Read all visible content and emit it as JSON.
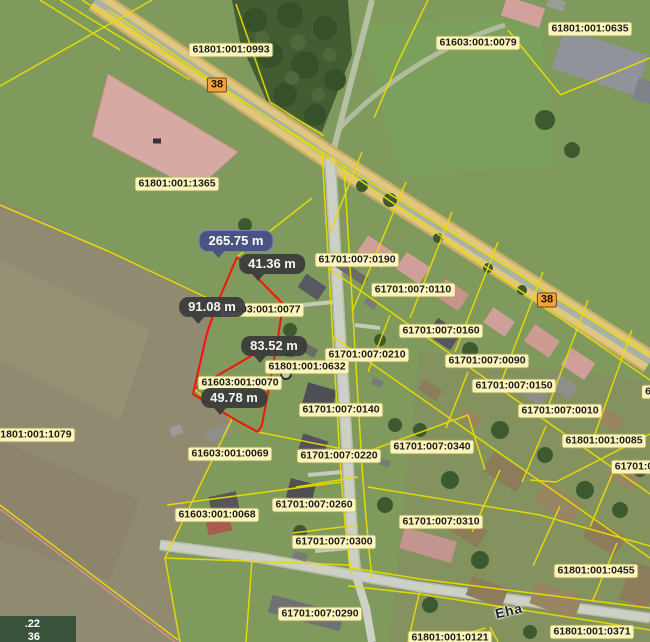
{
  "theme": {
    "parcel_line": "#e8dc00",
    "measure_line": "#f21404",
    "label_bg": "#fcf5bb",
    "label_text": "#1c1c1c",
    "measure_primary_bg": "#4a5383",
    "measure_secondary_bg": "#3b3b3b",
    "road_badge_bg": "#f2a33c",
    "highlight_field_fill": "#d6a9a3"
  },
  "map": {
    "parcel_labels": [
      {
        "text": "61801:001:0993",
        "x": 231,
        "y": 50
      },
      {
        "text": "61603:001:0079",
        "x": 478,
        "y": 43
      },
      {
        "text": "61801:001:0635",
        "x": 590,
        "y": 29
      },
      {
        "text": "61801:001:1365",
        "x": 177,
        "y": 184
      },
      {
        "text": "61701:007:0190",
        "x": 357,
        "y": 260
      },
      {
        "text": "61701:007:0110",
        "x": 413,
        "y": 290
      },
      {
        "text": "61603:001:0077",
        "x": 262,
        "y": 310
      },
      {
        "text": "61701:007:0160",
        "x": 441,
        "y": 331
      },
      {
        "text": "61701:007:0210",
        "x": 367,
        "y": 355
      },
      {
        "text": "61701:007:0090",
        "x": 487,
        "y": 361
      },
      {
        "text": "61801:001:0632",
        "x": 307,
        "y": 367
      },
      {
        "text": "61701:007:0150",
        "x": 514,
        "y": 386
      },
      {
        "text": "61603:001:0070",
        "x": 240,
        "y": 383
      },
      {
        "text": "61701:007:0140",
        "x": 341,
        "y": 410
      },
      {
        "text": "61701:007:0010",
        "x": 560,
        "y": 411
      },
      {
        "text": "61801:001:1079",
        "x": 33,
        "y": 435
      },
      {
        "text": "61801:001:0085",
        "x": 604,
        "y": 441
      },
      {
        "text": "61701:007:0340",
        "x": 432,
        "y": 447
      },
      {
        "text": "61603:001:0069",
        "x": 230,
        "y": 454
      },
      {
        "text": "61701:007:0220",
        "x": 339,
        "y": 456
      },
      {
        "text": "61701:0",
        "x": 634,
        "y": 467
      },
      {
        "text": "6",
        "x": 648,
        "y": 392
      },
      {
        "text": "61701:007:0260",
        "x": 314,
        "y": 505
      },
      {
        "text": "61603:001:0068",
        "x": 217,
        "y": 515
      },
      {
        "text": "61701:007:0310",
        "x": 441,
        "y": 522
      },
      {
        "text": "61701:007:0300",
        "x": 334,
        "y": 542
      },
      {
        "text": "61801:001:0455",
        "x": 596,
        "y": 571
      },
      {
        "text": "61701:007:0290",
        "x": 320,
        "y": 614
      },
      {
        "text": "61801:001:0371",
        "x": 592,
        "y": 632
      },
      {
        "text": "61801:001:0121",
        "x": 450,
        "y": 638
      }
    ],
    "road_badges": [
      {
        "text": "38",
        "x": 217,
        "y": 85
      },
      {
        "text": "38",
        "x": 547,
        "y": 300
      }
    ],
    "measurements": [
      {
        "text": "265.75 m",
        "x": 236,
        "y": 241,
        "variant": "primary"
      },
      {
        "text": "41.36 m",
        "x": 272,
        "y": 264,
        "variant": "secondary"
      },
      {
        "text": "91.08 m",
        "x": 212,
        "y": 307,
        "variant": "secondary"
      },
      {
        "text": "83.52 m",
        "x": 274,
        "y": 346,
        "variant": "secondary"
      },
      {
        "text": "49.78 m",
        "x": 234,
        "y": 398,
        "variant": "secondary"
      }
    ],
    "street_labels": [
      {
        "text": "Eha",
        "x": 509,
        "y": 611,
        "rotation": -13
      }
    ],
    "map_symbols": [
      {
        "name": "utility-symbol",
        "x": 290,
        "y": 354,
        "shape": "square"
      },
      {
        "name": "well-symbol",
        "x": 286,
        "y": 374,
        "shape": "round"
      },
      {
        "name": "survey-mark",
        "x": 157,
        "y": 141,
        "shape": "square"
      }
    ],
    "coordinate_overlay": {
      "line1": ".22",
      "line2": "36"
    }
  }
}
